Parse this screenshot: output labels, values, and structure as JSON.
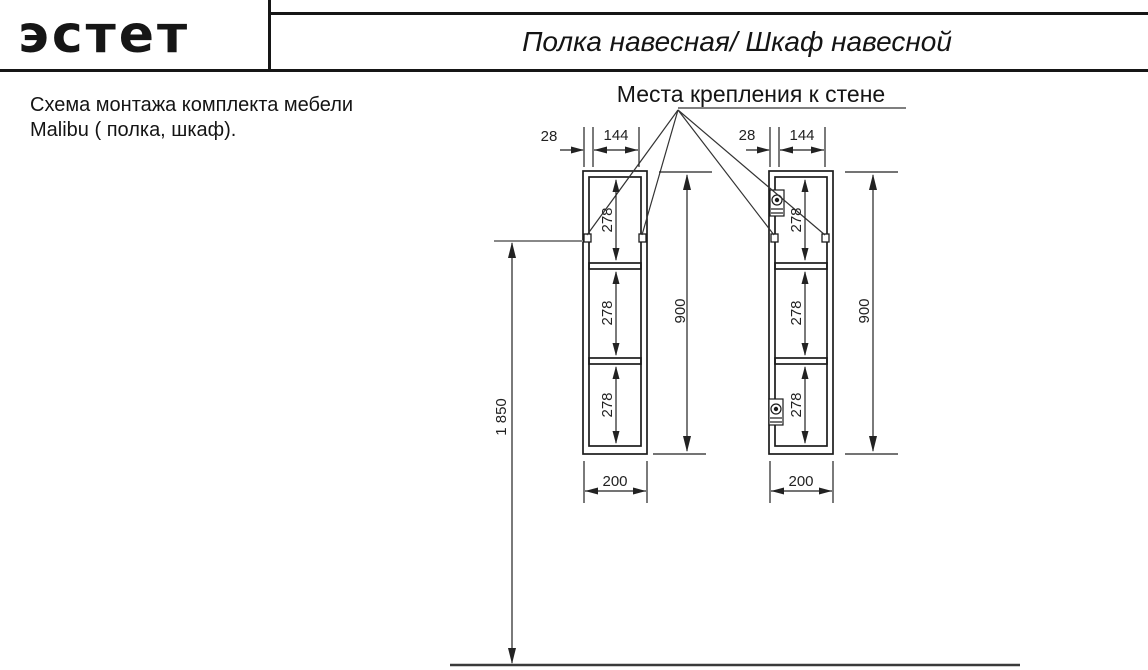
{
  "header": {
    "logo_text": "эстет",
    "title": "Полка навесная/ Шкаф навесной"
  },
  "description": {
    "line1": "Схема монтажа комплекта мебели",
    "line2": "Malibu ( полка, шкаф)."
  },
  "callout": {
    "label": "Места крепления к стене"
  },
  "dimensions": {
    "edge_offset": "28",
    "bracket_spacing": "144",
    "compartment_height": "278",
    "unit_height": "900",
    "unit_width": "200",
    "mounting_height": "1 850"
  },
  "colors": {
    "ink": "#1c1c1c",
    "background": "#ffffff"
  }
}
